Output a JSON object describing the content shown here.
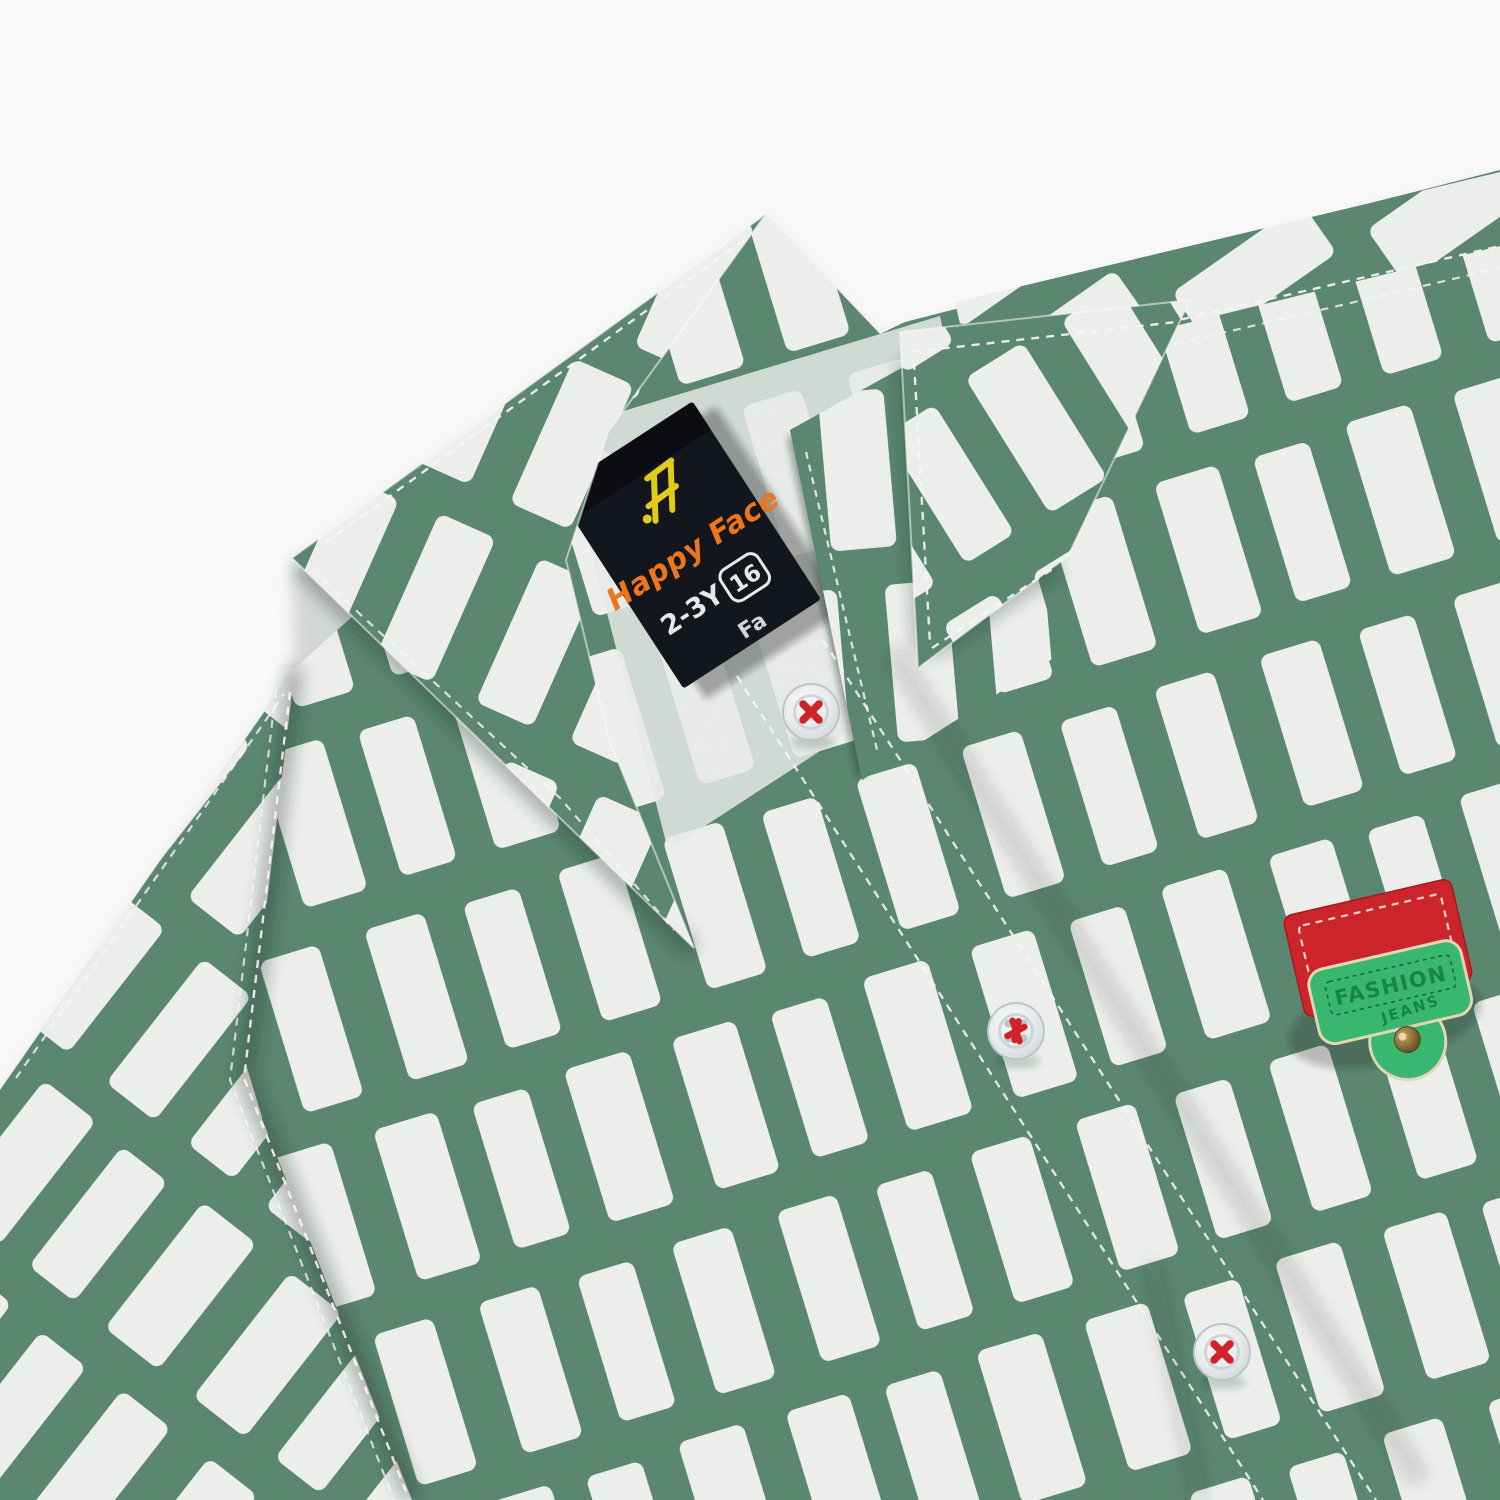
{
  "photo": {
    "alt": "Close-up product photo of a kids green and white block-print shirt: spread collar, inner brand label, clear buttons with red thread, and a red-green leather patch"
  },
  "palette": {
    "background": "#FFFFFF",
    "fabric_green": "#5E8A74",
    "fabric_white": "#F3F5F3",
    "stitch_white": "#FDFDFD",
    "thread_red": "#D6232B"
  },
  "brand_label": {
    "background": "#14171E",
    "logo_icon": "happy-face-monogram",
    "logo_color": "#E8D119",
    "brand_name": "Happy Face",
    "brand_color": "#F5791D",
    "size_text": "2-3Y",
    "size_badge": "16",
    "partial_text": "Fa",
    "text_color": "#EDEFF2"
  },
  "fashion_patch": {
    "line1": "FASHION",
    "line2": "JEANS",
    "red": "#D2262D",
    "green": "#3BBC74",
    "text_color": "#188A47",
    "rivet_color": "#8A6D3B"
  },
  "buttons": {
    "count": 3,
    "thread_color": "#D6232B"
  }
}
